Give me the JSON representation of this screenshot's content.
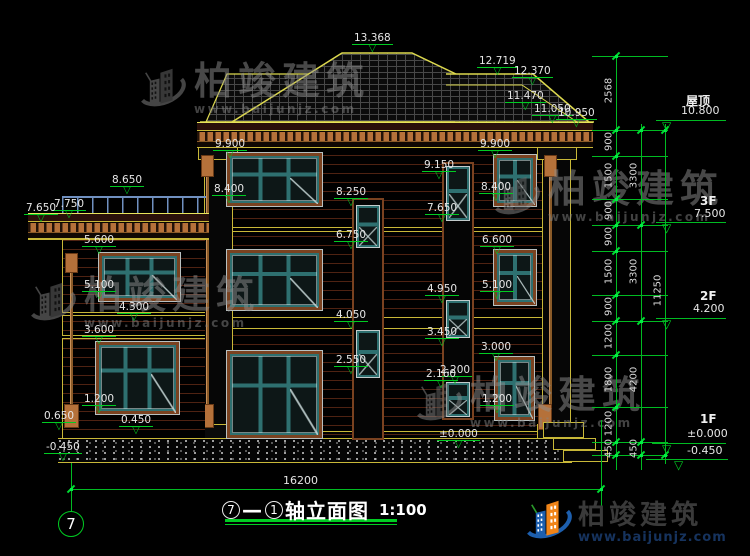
{
  "title_block": {
    "axis_start": "7",
    "dash": "—",
    "axis_end": "1",
    "name": "轴立面图",
    "scale": "1:100"
  },
  "grid": {
    "bubble_left": "7",
    "total_width_dim": "16200"
  },
  "colors": {
    "dim_green": "#00cc22",
    "outline_yellow": "#ddd94e",
    "cornice_tan": "#b5713a",
    "siding_maroon": "#4e2212",
    "window_teal": "#2e7070",
    "window_surround_brown": "#7a4220",
    "railing_blue": "#7090c0",
    "logo_blue": "#1d5fae",
    "logo_orange": "#f08418",
    "logo_text": "#3a3a3a",
    "logo_url": "#16335e",
    "watermark_gray": "#8f8f8f"
  },
  "floor_levels": [
    {
      "name": "屋顶",
      "value": "10.800",
      "nx": 686,
      "ny": 92,
      "vx": 681,
      "vy": 104,
      "lx": 656,
      "lw": 70,
      "ly": 120,
      "tx": 662
    },
    {
      "name": "3F",
      "value": "7.500",
      "nx": 700,
      "ny": 194,
      "vx": 694,
      "vy": 207,
      "lx": 656,
      "lw": 70,
      "ly": 222,
      "tx": 662
    },
    {
      "name": "2F",
      "value": "4.200",
      "nx": 700,
      "ny": 289,
      "vx": 693,
      "vy": 302,
      "lx": 656,
      "lw": 70,
      "ly": 318,
      "tx": 662
    },
    {
      "name": "1F",
      "value": "±0.000",
      "nx": 700,
      "ny": 412,
      "vx": 687,
      "vy": 427,
      "lx": 652,
      "lw": 74,
      "ly": 443,
      "tx": 662
    },
    {
      "name": "",
      "value": "-0.450",
      "nx": 0,
      "ny": 0,
      "vx": 687,
      "vy": 444,
      "lx": 646,
      "lw": 82,
      "ly": 459,
      "tx": 674
    }
  ],
  "elevation_markers": [
    {
      "label": "13.368",
      "x": 352,
      "y": 33
    },
    {
      "label": "12.719",
      "x": 477,
      "y": 56
    },
    {
      "label": "12.370",
      "x": 512,
      "y": 66
    },
    {
      "label": "11.470",
      "x": 505,
      "y": 91
    },
    {
      "label": "11.050",
      "x": 532,
      "y": 104
    },
    {
      "label": "10.950",
      "x": 556,
      "y": 108
    },
    {
      "label": "9.900",
      "x": 213,
      "y": 139
    },
    {
      "label": "9.900",
      "x": 478,
      "y": 139
    },
    {
      "label": "9.150",
      "x": 422,
      "y": 160
    },
    {
      "label": "8.650",
      "x": 110,
      "y": 175
    },
    {
      "label": "8.400",
      "x": 212,
      "y": 184
    },
    {
      "label": "8.400",
      "x": 479,
      "y": 182
    },
    {
      "label": "8.250",
      "x": 334,
      "y": 187
    },
    {
      "label": "7.750",
      "x": 52,
      "y": 199
    },
    {
      "label": "7.650",
      "x": 24,
      "y": 203
    },
    {
      "label": "7.650",
      "x": 425,
      "y": 203
    },
    {
      "label": "6.750",
      "x": 334,
      "y": 230
    },
    {
      "label": "6.600",
      "x": 480,
      "y": 235
    },
    {
      "label": "5.600",
      "x": 82,
      "y": 235
    },
    {
      "label": "5.100",
      "x": 82,
      "y": 280
    },
    {
      "label": "5.100",
      "x": 480,
      "y": 280
    },
    {
      "label": "4.950",
      "x": 425,
      "y": 284
    },
    {
      "label": "4.300",
      "x": 117,
      "y": 302
    },
    {
      "label": "4.050",
      "x": 334,
      "y": 310
    },
    {
      "label": "3.600",
      "x": 82,
      "y": 325
    },
    {
      "label": "3.450",
      "x": 425,
      "y": 327
    },
    {
      "label": "3.000",
      "x": 479,
      "y": 342
    },
    {
      "label": "2.550",
      "x": 334,
      "y": 355
    },
    {
      "label": "2.200",
      "x": 438,
      "y": 365
    },
    {
      "label": "2.160",
      "x": 424,
      "y": 369
    },
    {
      "label": "1.200",
      "x": 82,
      "y": 394
    },
    {
      "label": "1.200",
      "x": 480,
      "y": 394
    },
    {
      "label": "0.650",
      "x": 42,
      "y": 411
    },
    {
      "label": "0.450",
      "x": 119,
      "y": 415
    },
    {
      "label": "±0.000",
      "x": 437,
      "y": 429
    },
    {
      "label": "-0.450",
      "x": 44,
      "y": 442
    }
  ],
  "dimensions": {
    "columns": [
      {
        "x": 616,
        "y1": 56,
        "y2": 470,
        "ticks": [
          56,
          130,
          156,
          199,
          225,
          251,
          295,
          321,
          355,
          407,
          442,
          455
        ],
        "labels": [
          {
            "t": "2568",
            "y": 85
          },
          {
            "t": "900",
            "y": 136
          },
          {
            "t": "1500",
            "y": 170
          },
          {
            "t": "900",
            "y": 205
          },
          {
            "t": "900",
            "y": 231
          },
          {
            "t": "1500",
            "y": 266
          },
          {
            "t": "900",
            "y": 301
          },
          {
            "t": "1200",
            "y": 331
          },
          {
            "t": "1800",
            "y": 374
          },
          {
            "t": "1200",
            "y": 418
          },
          {
            "t": "450",
            "y": 443
          }
        ]
      },
      {
        "x": 641,
        "y1": 124,
        "y2": 470,
        "ticks": [
          130,
          225,
          321,
          442,
          455
        ],
        "labels": [
          {
            "t": "3300",
            "y": 170
          },
          {
            "t": "3300",
            "y": 266
          },
          {
            "t": "4200",
            "y": 374
          },
          {
            "t": "450",
            "y": 443
          }
        ]
      },
      {
        "x": 665,
        "y1": 124,
        "y2": 464,
        "ticks": [
          130,
          455
        ],
        "labels": [
          {
            "t": "11250",
            "y": 285
          }
        ]
      }
    ],
    "connector_ys": [
      56,
      130,
      156,
      199,
      225,
      251,
      295,
      321,
      355,
      407,
      442,
      455
    ],
    "bottom": {
      "label": "16200",
      "lx": 283,
      "ly": 474,
      "y": 489,
      "x1": 71,
      "x2": 601,
      "ext_left": {
        "x": 71,
        "y1": 463,
        "y2": 512
      },
      "ext_right": {
        "x": 601,
        "y1": 420,
        "y2": 524
      }
    }
  },
  "watermark": {
    "brand": "柏竣建筑",
    "url": "www.baijunjz.com",
    "positions": [
      {
        "x": 136,
        "y": 62
      },
      {
        "x": 490,
        "y": 170
      },
      {
        "x": 26,
        "y": 276
      },
      {
        "x": 412,
        "y": 376
      }
    ]
  },
  "logo": {
    "brand": "柏竣建筑",
    "url": "www.baijunjz.com"
  }
}
